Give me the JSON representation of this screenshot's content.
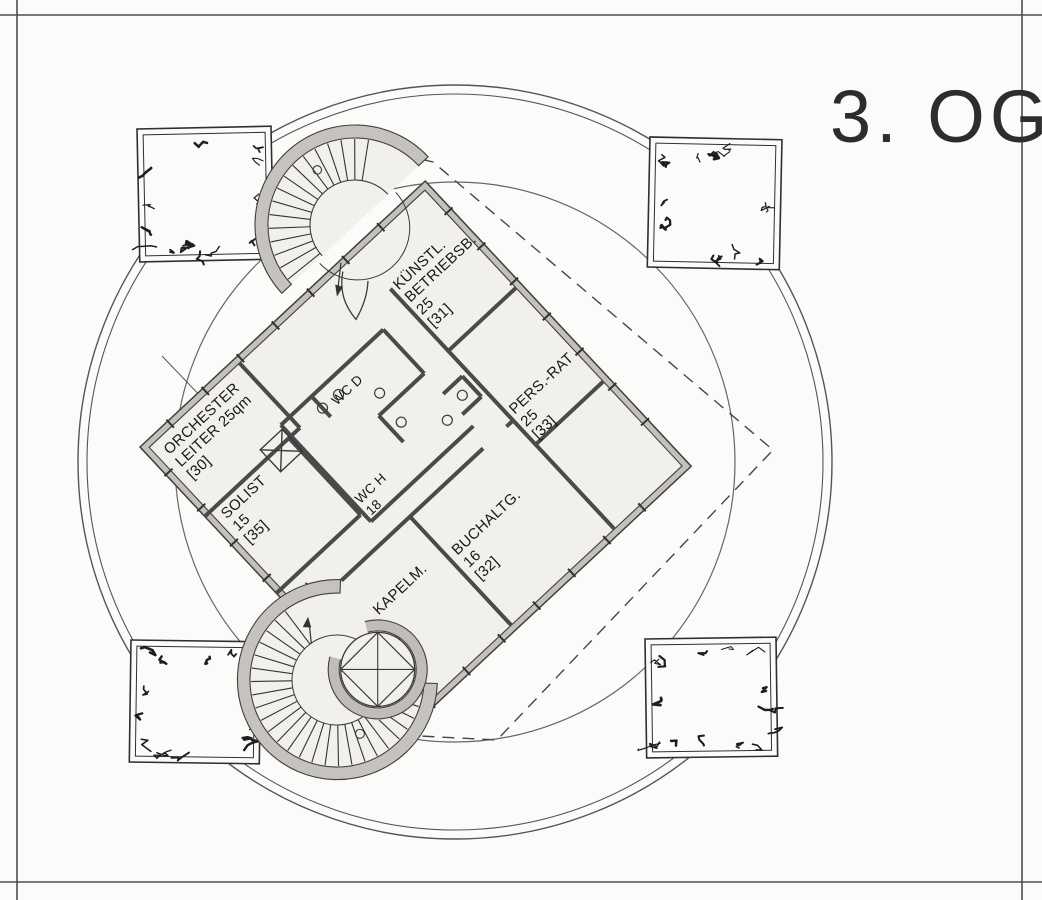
{
  "floor": {
    "title": "3. OG"
  },
  "colors": {
    "ink": "#2e2e2e",
    "wall_fill": "#c4c1bc",
    "paper": "#fbfbf9",
    "interior": "#f2f0ec"
  },
  "rooms": {
    "r30": {
      "name": "ORCHESTER LEITER",
      "size": "25qm",
      "id": "30",
      "lines": [
        "ORCHESTER",
        "LEITER 25qm",
        "[30]"
      ]
    },
    "r35": {
      "name": "SOLIST",
      "size": "15",
      "id": "35",
      "lines": [
        "SOLIST",
        "15",
        "[35]"
      ]
    },
    "r31": {
      "name": "KÜNSTL. BETRIEBSB.",
      "size": "25",
      "id": "31",
      "lines": [
        "KÜNSTL.",
        "BETRIEBSB.",
        "25",
        "[31]"
      ]
    },
    "r33": {
      "name": "PERS.-RAT",
      "size": "25",
      "id": "33",
      "lines": [
        "PERS.-RAT",
        "25",
        "[33]"
      ]
    },
    "r32": {
      "name": "BUCHALTG.",
      "size": "16",
      "id": "32",
      "lines": [
        "BUCHALTG.",
        "16",
        "[32]"
      ]
    },
    "r34": {
      "name": "1. KAPELM.",
      "size": "16",
      "id": "34",
      "lines": [
        "1. KAPELM.",
        "16",
        "[34]"
      ]
    },
    "wcd": {
      "name": "WC D",
      "lines": [
        "WC D"
      ]
    },
    "wch": {
      "name": "WC H",
      "size": "18",
      "lines": [
        "WC H",
        "18"
      ]
    }
  }
}
